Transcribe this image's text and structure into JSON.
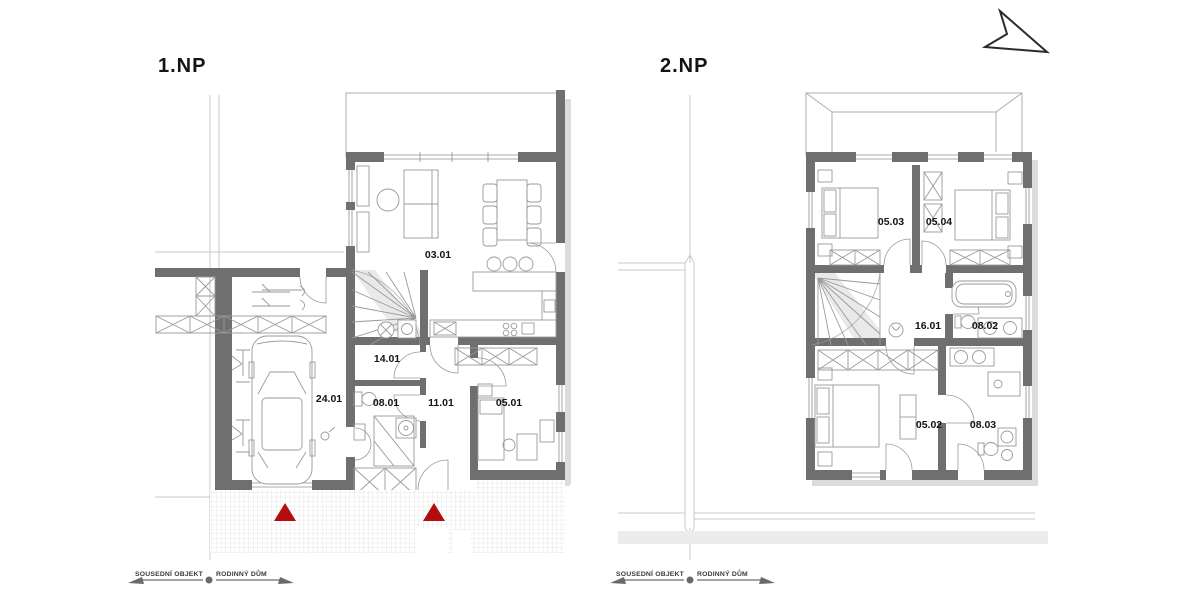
{
  "document": {
    "kind": "architectural-floor-plans",
    "sheet_background": "#ffffff"
  },
  "plans": [
    {
      "title": "1.NP",
      "rooms": [
        "03.01",
        "14.01",
        "24.01",
        "08.01",
        "11.01",
        "05.01"
      ],
      "boundary_left": "SOUSEDNÍ OBJEKT",
      "boundary_right": "RODINNÝ DŮM"
    },
    {
      "title": "2.NP",
      "rooms": [
        "05.03",
        "05.04",
        "16.01",
        "08.02",
        "05.02",
        "08.03"
      ],
      "boundary_left": "SOUSEDNÍ OBJEKT",
      "boundary_right": "RODINNÝ DŮM"
    }
  ],
  "icons": {
    "north_arrow": "north-arrow",
    "entrance_marker": "red-triangle"
  },
  "colors": {
    "wall_gray": "#6f6f6f",
    "shadow_gray": "#dcdcdc",
    "line_gray": "#9a9a9a",
    "accent_red": "#b30d10"
  }
}
